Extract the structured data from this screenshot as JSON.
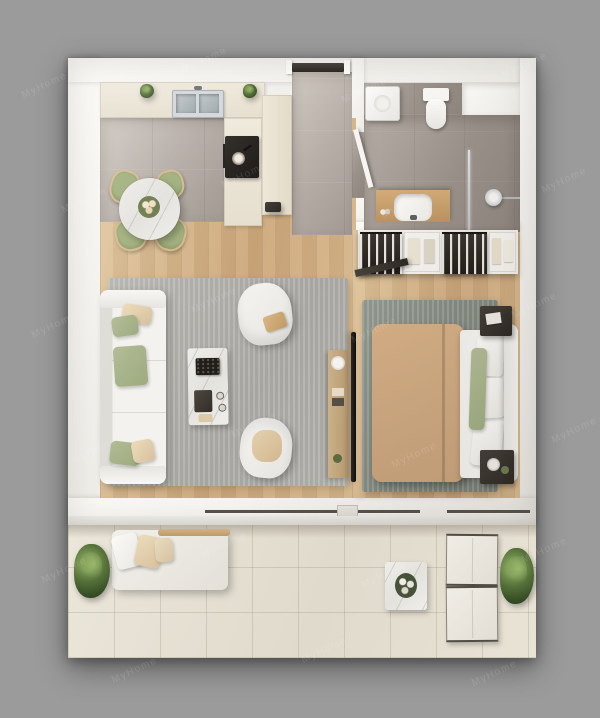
{
  "watermark": {
    "text": "MyHome"
  },
  "palette": {
    "background": "#9b9b9b",
    "plan_base": "#f4f2ef",
    "wall": "#fbfaf7",
    "wood": "#cda77a",
    "kitchen_tile": "#b7afa8",
    "bath_tile": "#9a918a",
    "balcony_tile": "#e0dacc",
    "rug_living": "#aeaca7",
    "rug_bedroom": "#868d83",
    "white_furniture": "#f5f4f1",
    "blanket_tan": "#c7a27b",
    "accent_green": "#9dab80",
    "accent_tan": "#d8c09c",
    "dark_furniture": "#453f39",
    "counter_cream": "#f0eadd",
    "console_wood": "#cdb28a",
    "plant_green": "#55713a",
    "marble": "#e4e2dd",
    "window_frame": "#57524c"
  },
  "scene": {
    "view": "top-down 3D rendered apartment floor plan",
    "rooms": [
      {
        "name": "kitchen-dining",
        "floor": "gray tile",
        "items": [
          {
            "item": "kitchen-counter"
          },
          {
            "item": "double-basin-sink"
          },
          {
            "item": "cooktop-with-pan"
          },
          {
            "item": "oven"
          },
          {
            "item": "tall-cabinet"
          },
          {
            "item": "counter-plant",
            "count": 2
          },
          {
            "item": "round-dining-table"
          },
          {
            "item": "flower-centerpiece"
          },
          {
            "item": "dining-chair",
            "count": 4
          }
        ]
      },
      {
        "name": "entry-hall",
        "floor": "gray tile",
        "items": [
          {
            "item": "front-door"
          }
        ]
      },
      {
        "name": "bathroom",
        "floor": "gray tile",
        "items": [
          {
            "item": "washing-machine"
          },
          {
            "item": "toilet"
          },
          {
            "item": "vanity-with-sink"
          },
          {
            "item": "shower-glass-screen"
          },
          {
            "item": "shower-head"
          },
          {
            "item": "bathroom-door"
          }
        ]
      },
      {
        "name": "living-room",
        "floor": "wood",
        "items": [
          {
            "item": "sofa"
          },
          {
            "item": "throw-pillow",
            "count": 5
          },
          {
            "item": "armchair",
            "count": 2
          },
          {
            "item": "coffee-table"
          },
          {
            "item": "area-rug"
          },
          {
            "item": "tv"
          },
          {
            "item": "media-console"
          }
        ]
      },
      {
        "name": "bedroom",
        "floor": "wood",
        "items": [
          {
            "item": "open-wardrobe"
          },
          {
            "item": "double-bed"
          },
          {
            "item": "nightstand",
            "count": 2
          },
          {
            "item": "area-rug"
          },
          {
            "item": "bedroom-door"
          }
        ]
      },
      {
        "name": "balcony",
        "floor": "beige tile",
        "items": [
          {
            "item": "daybed-lounger"
          },
          {
            "item": "plant",
            "count": 2
          },
          {
            "item": "side-table"
          },
          {
            "item": "outdoor-chair",
            "count": 2
          }
        ]
      }
    ]
  }
}
